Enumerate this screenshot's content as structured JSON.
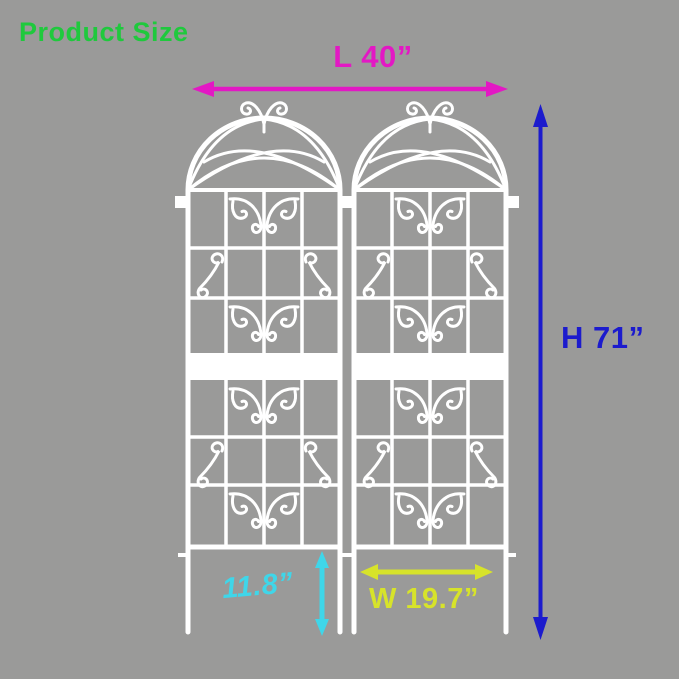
{
  "header": {
    "title": "Product Size"
  },
  "colors": {
    "background": "#9a9a99",
    "trellis_white": "#ffffff",
    "title_green": "#1fc93d",
    "length_magenta": "#e318c4",
    "height_blue": "#1c1bcd",
    "stake_cyan": "#3fd6e9",
    "width_yellow": "#d7e32a"
  },
  "annotations": {
    "length": {
      "label": "L 40”",
      "value": 40,
      "unit": "inches"
    },
    "height": {
      "label": "H 71”",
      "value": 71,
      "unit": "inches"
    },
    "stake": {
      "label": "11.8”",
      "value": 11.8,
      "unit": "inches"
    },
    "width": {
      "label": "W 19.7”",
      "value": 19.7,
      "unit": "inches"
    }
  },
  "illustration": {
    "subject": "two arched white metal garden trellis panels with scrollwork and ground stakes",
    "panel_count": 2
  }
}
